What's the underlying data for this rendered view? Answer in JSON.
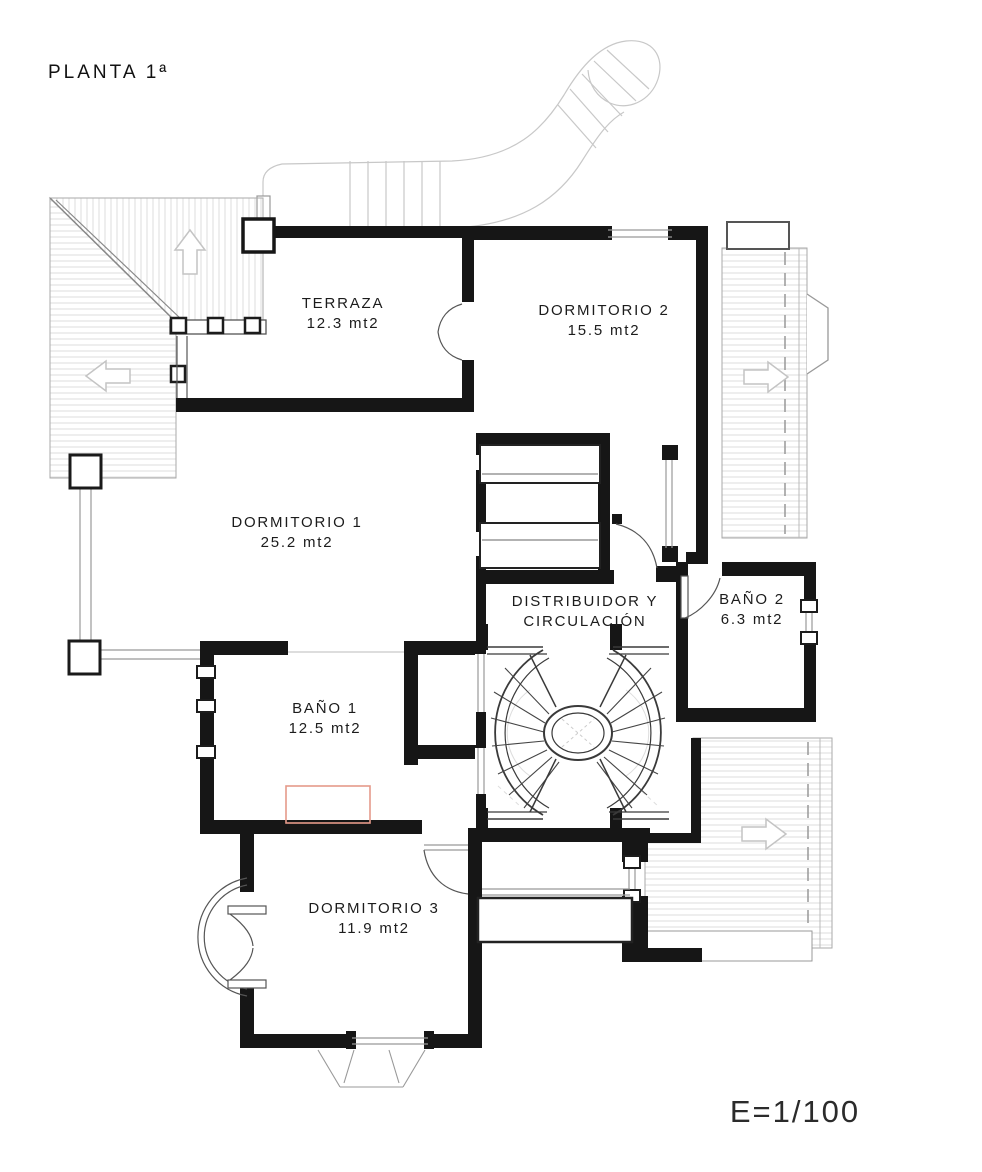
{
  "drawing": {
    "title": "PLANTA 1ª",
    "scale_label": "E=1/100",
    "type": "architectural floor plan, first floor"
  },
  "rooms": [
    {
      "id": "terraza",
      "name": "TERRAZA",
      "sublabel": "12.3 mt2"
    },
    {
      "id": "dormitorio-2",
      "name": "DORMITORIO 2",
      "sublabel": "15.5 mt2"
    },
    {
      "id": "dormitorio-1",
      "name": "DORMITORIO 1",
      "sublabel": "25.2 mt2"
    },
    {
      "id": "distribuidor",
      "name": "DISTRIBUIDOR Y",
      "sublabel": "CIRCULACIÓN"
    },
    {
      "id": "bano-2",
      "name": "BAÑO 2",
      "sublabel": "6.3 mt2"
    },
    {
      "id": "bano-1",
      "name": "BAÑO 1",
      "sublabel": "12.5 mt2"
    },
    {
      "id": "dormitorio-3",
      "name": "DORMITORIO 3",
      "sublabel": "11.9 mt2"
    }
  ],
  "colors": {
    "wall": "#161616",
    "thin_line": "#555555",
    "gray_line": "#999999",
    "light_line": "#c8c8c8",
    "hatch": "#dcdcdc",
    "fixture_red": "#e59a8a",
    "background": "#ffffff"
  }
}
